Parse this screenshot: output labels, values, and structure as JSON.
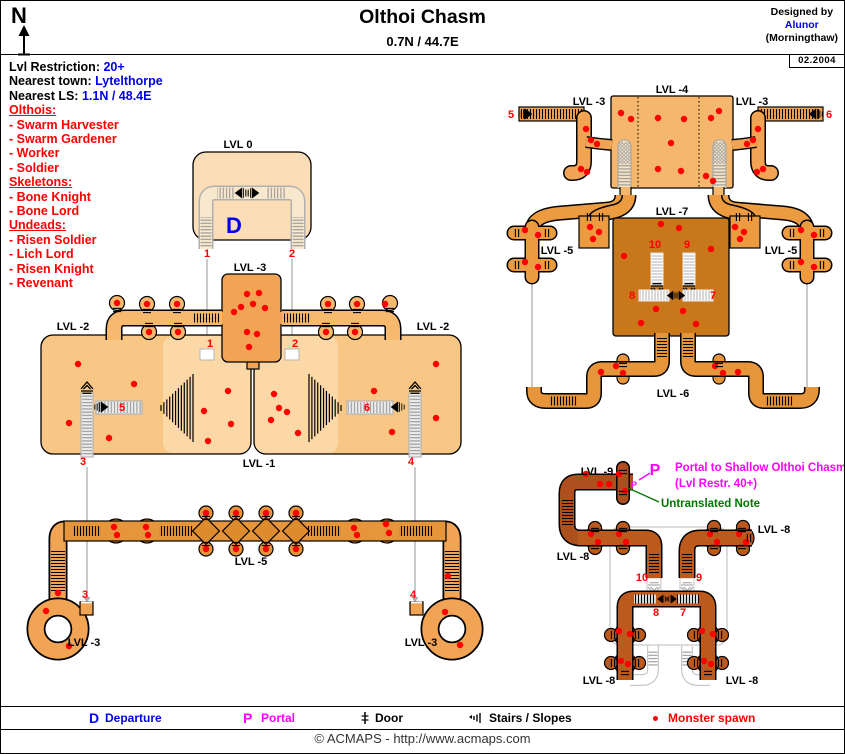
{
  "header": {
    "compass": "N",
    "title": "Olthoi Chasm",
    "coords": "0.7N / 44.7E",
    "designed_by": "Designed by",
    "author": "Alunor",
    "server": "(Morningthaw)",
    "date": "02.2004"
  },
  "info": {
    "restriction_label": "Lvl Restriction:",
    "restriction_value": "20+",
    "town_label": "Nearest town:",
    "town_value": "Lytelthorpe",
    "ls_label": "Nearest LS:",
    "ls_value": "1.1N / 48.4E",
    "groups": [
      {
        "title": "Olthois:",
        "items": [
          "- Swarm Harvester",
          "- Swarm Gardener",
          "- Worker",
          "- Soldier"
        ]
      },
      {
        "title": "Skeletons:",
        "items": [
          "- Bone Knight",
          "- Bone Lord"
        ]
      },
      {
        "title": "Undeads:",
        "items": [
          "- Risen Soldier",
          "- Lich Lord",
          "- Risen Knight",
          "- Revenant"
        ]
      }
    ]
  },
  "map": {
    "departure_letter": "D",
    "portal_letter": "P",
    "portal_node_letter": "P",
    "portal_note_line1": "Portal to Shallow Olthoi Chasm",
    "portal_note_line2": "(Lvl Restr. 40+)",
    "untranslated_note": "Untranslated Note",
    "level_labels": [
      {
        "t": "LVL 0",
        "x": 237,
        "y": 147
      },
      {
        "t": "LVL -3",
        "x": 249,
        "y": 270
      },
      {
        "t": "LVL -2",
        "x": 72,
        "y": 329
      },
      {
        "t": "LVL -2",
        "x": 432,
        "y": 329
      },
      {
        "t": "LVL -1",
        "x": 258,
        "y": 466
      },
      {
        "t": "LVL -5",
        "x": 250,
        "y": 564
      },
      {
        "t": "LVL -3",
        "x": 83,
        "y": 645
      },
      {
        "t": "LVL -3",
        "x": 420,
        "y": 645
      },
      {
        "t": "LVL -4",
        "x": 671,
        "y": 92
      },
      {
        "t": "LVL -3",
        "x": 588,
        "y": 104
      },
      {
        "t": "LVL -3",
        "x": 751,
        "y": 104
      },
      {
        "t": "LVL -7",
        "x": 671,
        "y": 214
      },
      {
        "t": "LVL -5",
        "x": 556,
        "y": 253
      },
      {
        "t": "LVL -5",
        "x": 780,
        "y": 253
      },
      {
        "t": "LVL -6",
        "x": 672,
        "y": 396
      },
      {
        "t": "LVL -9",
        "x": 596,
        "y": 474
      },
      {
        "t": "LVL -8",
        "x": 572,
        "y": 559
      },
      {
        "t": "LVL -8",
        "x": 773,
        "y": 532
      },
      {
        "t": "LVL -8",
        "x": 598,
        "y": 683
      },
      {
        "t": "LVL -8",
        "x": 741,
        "y": 683
      }
    ],
    "markers": [
      {
        "n": "1",
        "x": 206,
        "y": 256
      },
      {
        "n": "2",
        "x": 291,
        "y": 256
      },
      {
        "n": "1",
        "x": 209,
        "y": 346
      },
      {
        "n": "2",
        "x": 294,
        "y": 346
      },
      {
        "n": "3",
        "x": 82,
        "y": 464
      },
      {
        "n": "4",
        "x": 410,
        "y": 464
      },
      {
        "n": "5",
        "x": 121,
        "y": 410
      },
      {
        "n": "6",
        "x": 366,
        "y": 410
      },
      {
        "n": "5",
        "x": 510,
        "y": 117
      },
      {
        "n": "6",
        "x": 828,
        "y": 117
      },
      {
        "n": "3",
        "x": 84,
        "y": 597
      },
      {
        "n": "4",
        "x": 412,
        "y": 597
      },
      {
        "n": "10",
        "x": 654,
        "y": 247
      },
      {
        "n": "9",
        "x": 686,
        "y": 247
      },
      {
        "n": "8",
        "x": 631,
        "y": 298
      },
      {
        "n": "7",
        "x": 712,
        "y": 298
      },
      {
        "n": "10",
        "x": 641,
        "y": 580
      },
      {
        "n": "9",
        "x": 698,
        "y": 580
      },
      {
        "n": "8",
        "x": 655,
        "y": 615
      },
      {
        "n": "7",
        "x": 682,
        "y": 615
      }
    ],
    "spawns": [
      [
        116,
        302
      ],
      [
        146,
        303
      ],
      [
        176,
        303
      ],
      [
        148,
        331
      ],
      [
        177,
        331
      ],
      [
        327,
        303
      ],
      [
        356,
        303
      ],
      [
        384,
        303
      ],
      [
        354,
        331
      ],
      [
        325,
        331
      ],
      [
        246,
        293
      ],
      [
        258,
        292
      ],
      [
        240,
        306
      ],
      [
        252,
        303
      ],
      [
        264,
        307
      ],
      [
        233,
        311
      ],
      [
        246,
        331
      ],
      [
        256,
        333
      ],
      [
        248,
        346
      ],
      [
        77,
        363
      ],
      [
        133,
        383
      ],
      [
        227,
        390
      ],
      [
        203,
        410
      ],
      [
        230,
        423
      ],
      [
        68,
        422
      ],
      [
        108,
        437
      ],
      [
        207,
        440
      ],
      [
        273,
        393
      ],
      [
        278,
        407
      ],
      [
        286,
        411
      ],
      [
        270,
        419
      ],
      [
        297,
        432
      ],
      [
        373,
        390
      ],
      [
        435,
        363
      ],
      [
        435,
        417
      ],
      [
        391,
        431
      ],
      [
        113,
        526
      ],
      [
        116,
        534
      ],
      [
        145,
        526
      ],
      [
        147,
        534
      ],
      [
        205,
        512
      ],
      [
        235,
        512
      ],
      [
        265,
        512
      ],
      [
        295,
        512
      ],
      [
        205,
        548
      ],
      [
        235,
        548
      ],
      [
        265,
        548
      ],
      [
        295,
        548
      ],
      [
        353,
        527
      ],
      [
        356,
        534
      ],
      [
        385,
        523
      ],
      [
        388,
        532
      ],
      [
        447,
        575
      ],
      [
        57,
        592
      ],
      [
        45,
        610
      ],
      [
        68,
        645
      ],
      [
        444,
        611
      ],
      [
        459,
        644
      ],
      [
        585,
        128
      ],
      [
        590,
        139
      ],
      [
        596,
        143
      ],
      [
        580,
        168
      ],
      [
        586,
        171
      ],
      [
        757,
        128
      ],
      [
        752,
        139
      ],
      [
        746,
        143
      ],
      [
        762,
        168
      ],
      [
        756,
        171
      ],
      [
        620,
        112
      ],
      [
        630,
        118
      ],
      [
        657,
        117
      ],
      [
        683,
        118
      ],
      [
        710,
        117
      ],
      [
        718,
        110
      ],
      [
        670,
        142
      ],
      [
        657,
        168
      ],
      [
        680,
        170
      ],
      [
        705,
        175
      ],
      [
        712,
        180
      ],
      [
        589,
        226
      ],
      [
        598,
        231
      ],
      [
        592,
        238
      ],
      [
        734,
        226
      ],
      [
        743,
        231
      ],
      [
        739,
        238
      ],
      [
        524,
        229
      ],
      [
        537,
        234
      ],
      [
        524,
        261
      ],
      [
        537,
        266
      ],
      [
        800,
        229
      ],
      [
        813,
        234
      ],
      [
        800,
        261
      ],
      [
        813,
        266
      ],
      [
        660,
        223
      ],
      [
        678,
        227
      ],
      [
        710,
        248
      ],
      [
        623,
        255
      ],
      [
        655,
        308
      ],
      [
        682,
        310
      ],
      [
        640,
        322
      ],
      [
        695,
        323
      ],
      [
        600,
        371
      ],
      [
        615,
        365
      ],
      [
        622,
        372
      ],
      [
        714,
        365
      ],
      [
        722,
        372
      ],
      [
        737,
        371
      ],
      [
        585,
        473
      ],
      [
        599,
        483
      ],
      [
        618,
        473
      ],
      [
        624,
        490
      ],
      [
        608,
        483
      ],
      [
        590,
        533
      ],
      [
        597,
        541
      ],
      [
        618,
        533
      ],
      [
        625,
        541
      ],
      [
        709,
        533
      ],
      [
        716,
        541
      ],
      [
        738,
        533
      ],
      [
        745,
        541
      ],
      [
        618,
        630
      ],
      [
        629,
        633
      ],
      [
        620,
        660
      ],
      [
        627,
        663
      ],
      [
        701,
        630
      ],
      [
        712,
        633
      ],
      [
        703,
        660
      ],
      [
        710,
        663
      ]
    ],
    "gray_lines": [
      [
        206,
        258,
        206,
        345
      ],
      [
        291,
        258,
        291,
        345
      ],
      [
        86,
        466,
        86,
        597
      ],
      [
        414,
        466,
        414,
        597
      ],
      [
        531,
        282,
        531,
        389
      ],
      [
        806,
        282,
        806,
        389
      ]
    ],
    "ticks": [
      [
        116,
        309,
        0
      ],
      [
        146,
        310,
        0
      ],
      [
        176,
        310,
        0
      ],
      [
        148,
        324,
        0
      ],
      [
        177,
        324,
        0
      ],
      [
        389,
        309,
        0
      ],
      [
        356,
        310,
        0
      ],
      [
        327,
        310,
        0
      ],
      [
        354,
        324,
        0
      ],
      [
        325,
        324,
        0
      ],
      [
        205,
        517,
        0
      ],
      [
        235,
        517,
        0
      ],
      [
        265,
        517,
        0
      ],
      [
        295,
        517,
        0
      ],
      [
        205,
        543,
        0
      ],
      [
        235,
        543,
        0
      ],
      [
        265,
        543,
        0
      ],
      [
        295,
        543,
        0
      ],
      [
        588,
        216,
        90
      ],
      [
        600,
        216,
        90
      ],
      [
        737,
        216,
        90
      ],
      [
        749,
        216,
        90
      ],
      [
        516,
        232,
        90
      ],
      [
        546,
        232,
        90
      ],
      [
        516,
        264,
        90
      ],
      [
        546,
        264,
        90
      ],
      [
        791,
        232,
        90
      ],
      [
        821,
        232,
        90
      ],
      [
        791,
        264,
        90
      ],
      [
        821,
        264,
        90
      ],
      [
        622,
        364,
        0
      ],
      [
        718,
        364,
        0
      ],
      [
        622,
        471,
        0
      ],
      [
        622,
        492,
        0
      ],
      [
        594,
        529,
        0
      ],
      [
        622,
        529,
        0
      ],
      [
        594,
        546,
        0
      ],
      [
        622,
        546,
        0
      ],
      [
        713,
        529,
        0
      ],
      [
        741,
        529,
        0
      ],
      [
        713,
        546,
        0
      ],
      [
        741,
        546,
        0
      ],
      [
        748,
        537,
        90
      ],
      [
        612,
        634,
        90
      ],
      [
        636,
        634,
        90
      ],
      [
        612,
        662,
        90
      ],
      [
        636,
        662,
        90
      ],
      [
        695,
        634,
        90
      ],
      [
        719,
        634,
        90
      ],
      [
        695,
        662,
        90
      ],
      [
        719,
        662,
        90
      ],
      [
        624,
        672,
        0
      ],
      [
        707,
        672,
        0
      ]
    ],
    "fans": [
      {
        "apex": 160,
        "base": 192,
        "cy": 407,
        "min": 3,
        "max": 34,
        "n": 12
      },
      {
        "apex": 340,
        "base": 308,
        "cy": 407,
        "min": 3,
        "max": 34,
        "n": 12
      }
    ]
  },
  "legend": {
    "departure_key": "D",
    "departure_label": "Departure",
    "portal_key": "P",
    "portal_label": "Portal",
    "door_label": "Door",
    "stairs_label": "Stairs / Slopes",
    "spawn_label": "Monster spawn"
  },
  "footer": "© ACMAPS - http://www.acmaps.com",
  "colors": {
    "accent_blue": "#0000EE",
    "accent_red": "#FF0000",
    "accent_magenta": "#FF00FF",
    "accent_green": "#007800",
    "gray_line": "#ADADAD",
    "spawn": "#FF0000",
    "lvl0": "#FBDDB8",
    "lvl0_inner": "#F8E8CE",
    "lvl1": "#FBD8A6",
    "lvl2": "#F8C685",
    "lvl2c": "#F6B96E",
    "lvl3": "#F2A455",
    "lvl4": "#F5B66E",
    "lvl5": "#EC9B40",
    "lvl5b": "#E6953A",
    "diamond": "#DE8B2E",
    "lvl6": "#E6953A",
    "lvl7": "#C9771B",
    "lvl8": "#BC5A1D",
    "lvl9": "#AE501E",
    "ghost": "#C8C8C8"
  }
}
